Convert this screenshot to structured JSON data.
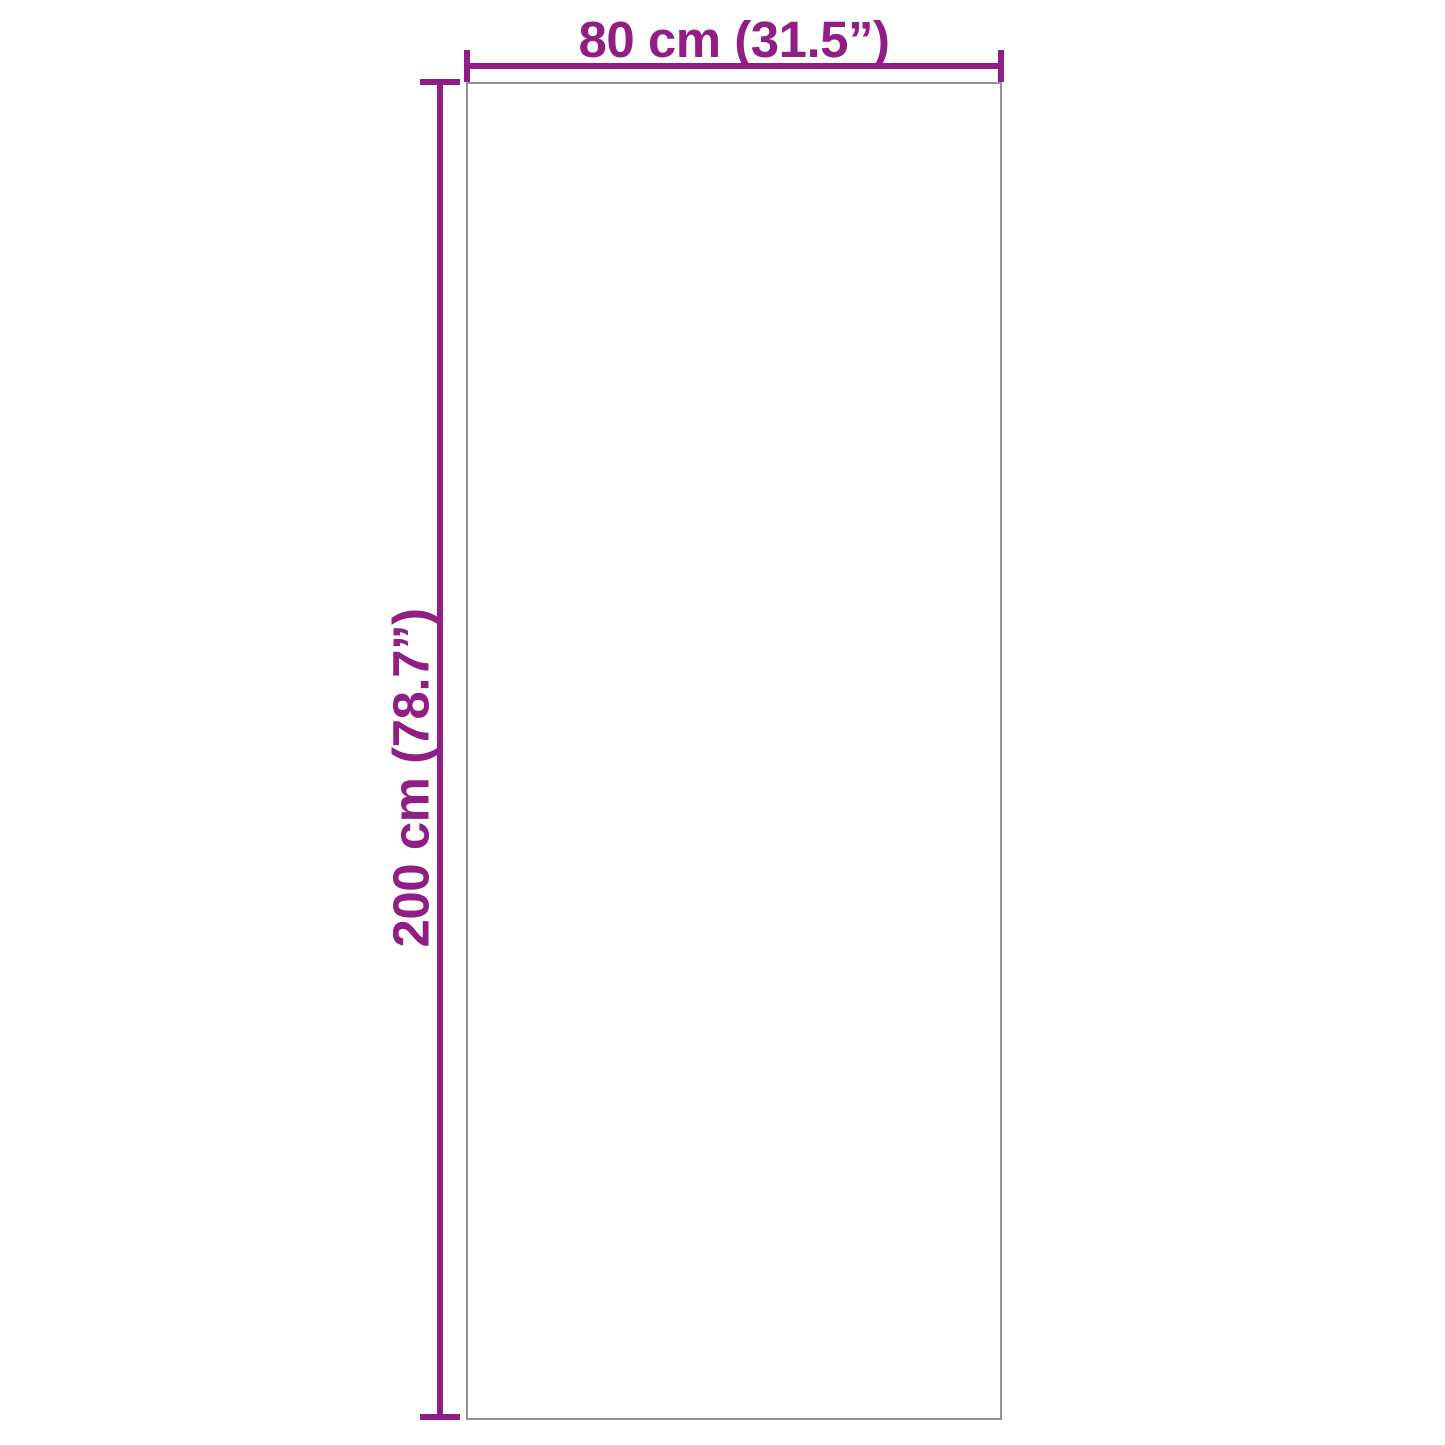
{
  "colors": {
    "dimension_line": "#911e84",
    "product_outline": "#929292",
    "page_background": "#ffffff"
  },
  "dimensions": {
    "width": {
      "label": "80 cm (31.5”)"
    },
    "height": {
      "label": "200 cm (78.7”)"
    }
  }
}
